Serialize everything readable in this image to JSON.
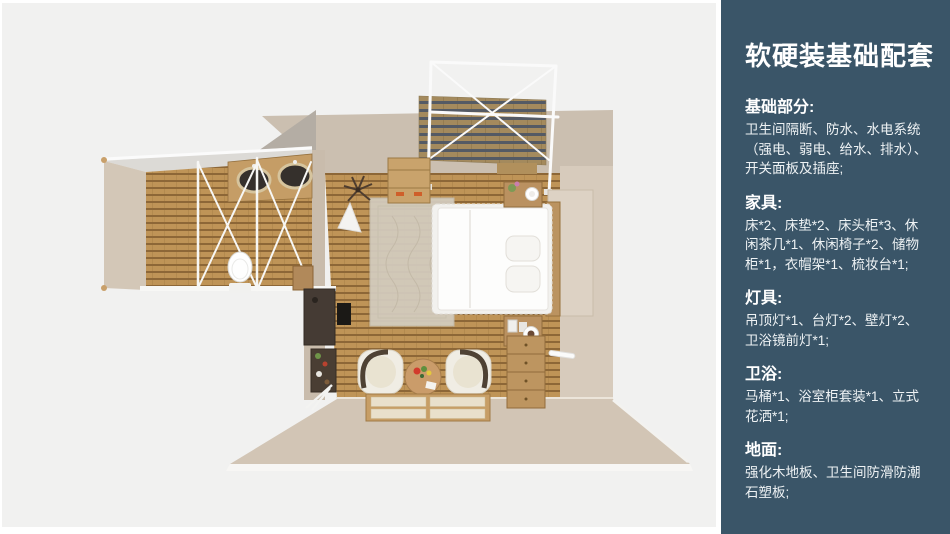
{
  "panel": {
    "title": "软硬装基础配套",
    "background_color": "#3a5568",
    "text_color": "#ffffff",
    "sections": [
      {
        "heading": "基础部分:",
        "body": "卫生间隔断、防水、水电系统（强电、弱电、给水、排水）、开关面板及插座;"
      },
      {
        "heading": "家具:",
        "body": "床*2、床垫*2、床头柜*3、休闲茶几*1、休闲椅子*2、储物柜*1，衣帽架*1、梳妆台*1;"
      },
      {
        "heading": "灯具:",
        "body": "吊顶灯*1、台灯*2、壁灯*2、卫浴镜前灯*1;"
      },
      {
        "heading": "卫浴:",
        "body": "马桶*1、浴室柜套装*1、立式花洒*1;"
      },
      {
        "heading": "地面:",
        "body": "强化木地板、卫生间防滑防潮石塑板;"
      }
    ]
  },
  "floorplan": {
    "type": "top-down 3D interior render",
    "rooms": [
      "bedroom",
      "bathroom",
      "balcony"
    ],
    "colors": {
      "background": "#f1f1f0",
      "wall": "#cbbfb0",
      "wood_floor": "#bf9457",
      "deck_stripe": "#545a64",
      "white_frame": "#fafafa"
    }
  }
}
